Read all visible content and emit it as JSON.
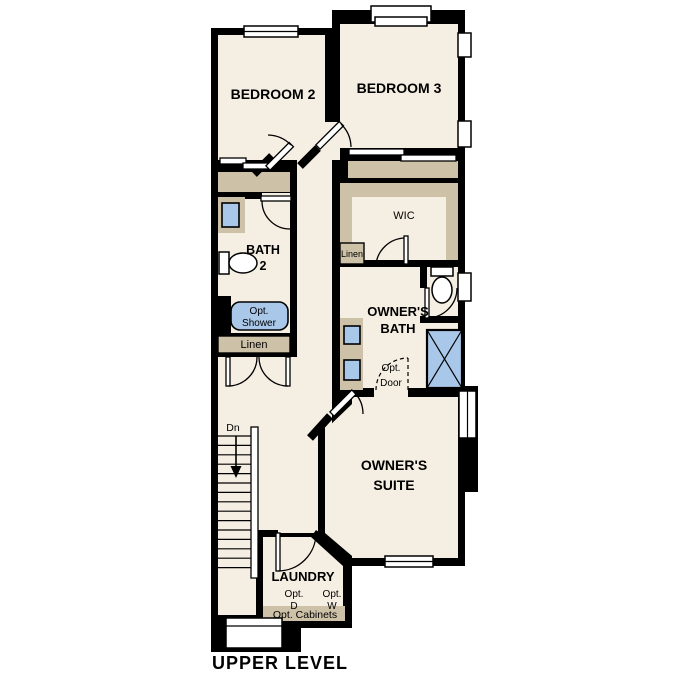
{
  "title": "UPPER LEVEL",
  "colors": {
    "background": "#ffffff",
    "wall": "#000000",
    "floor": "#f5eee2",
    "cabinet": "#cdc1a7",
    "fixture": "#a9c7e9"
  },
  "rooms": {
    "bedroom2": {
      "label": "BEDROOM 2"
    },
    "bedroom3": {
      "label": "BEDROOM 3"
    },
    "bath2": {
      "line1": "BATH",
      "line2": "2"
    },
    "wic": {
      "label": "WIC"
    },
    "owners_bath": {
      "line1": "OWNER'S",
      "line2": "BATH"
    },
    "owners_suite": {
      "line1": "OWNER'S",
      "line2": "SUITE"
    },
    "laundry": {
      "label": "LAUNDRY"
    }
  },
  "features": {
    "linen_upper": {
      "label": "Linen"
    },
    "linen_lower": {
      "label": "Linen"
    },
    "opt_shower": {
      "line1": "Opt.",
      "line2": "Shower"
    },
    "opt_door": {
      "line1": "Opt.",
      "line2": "Door"
    },
    "opt_dryer": {
      "line1": "Opt.",
      "line2": "D"
    },
    "opt_washer": {
      "line1": "Opt.",
      "line2": "W"
    },
    "opt_cabinets": {
      "label": "Opt. Cabinets"
    },
    "stairs": {
      "label": "Dn"
    }
  }
}
